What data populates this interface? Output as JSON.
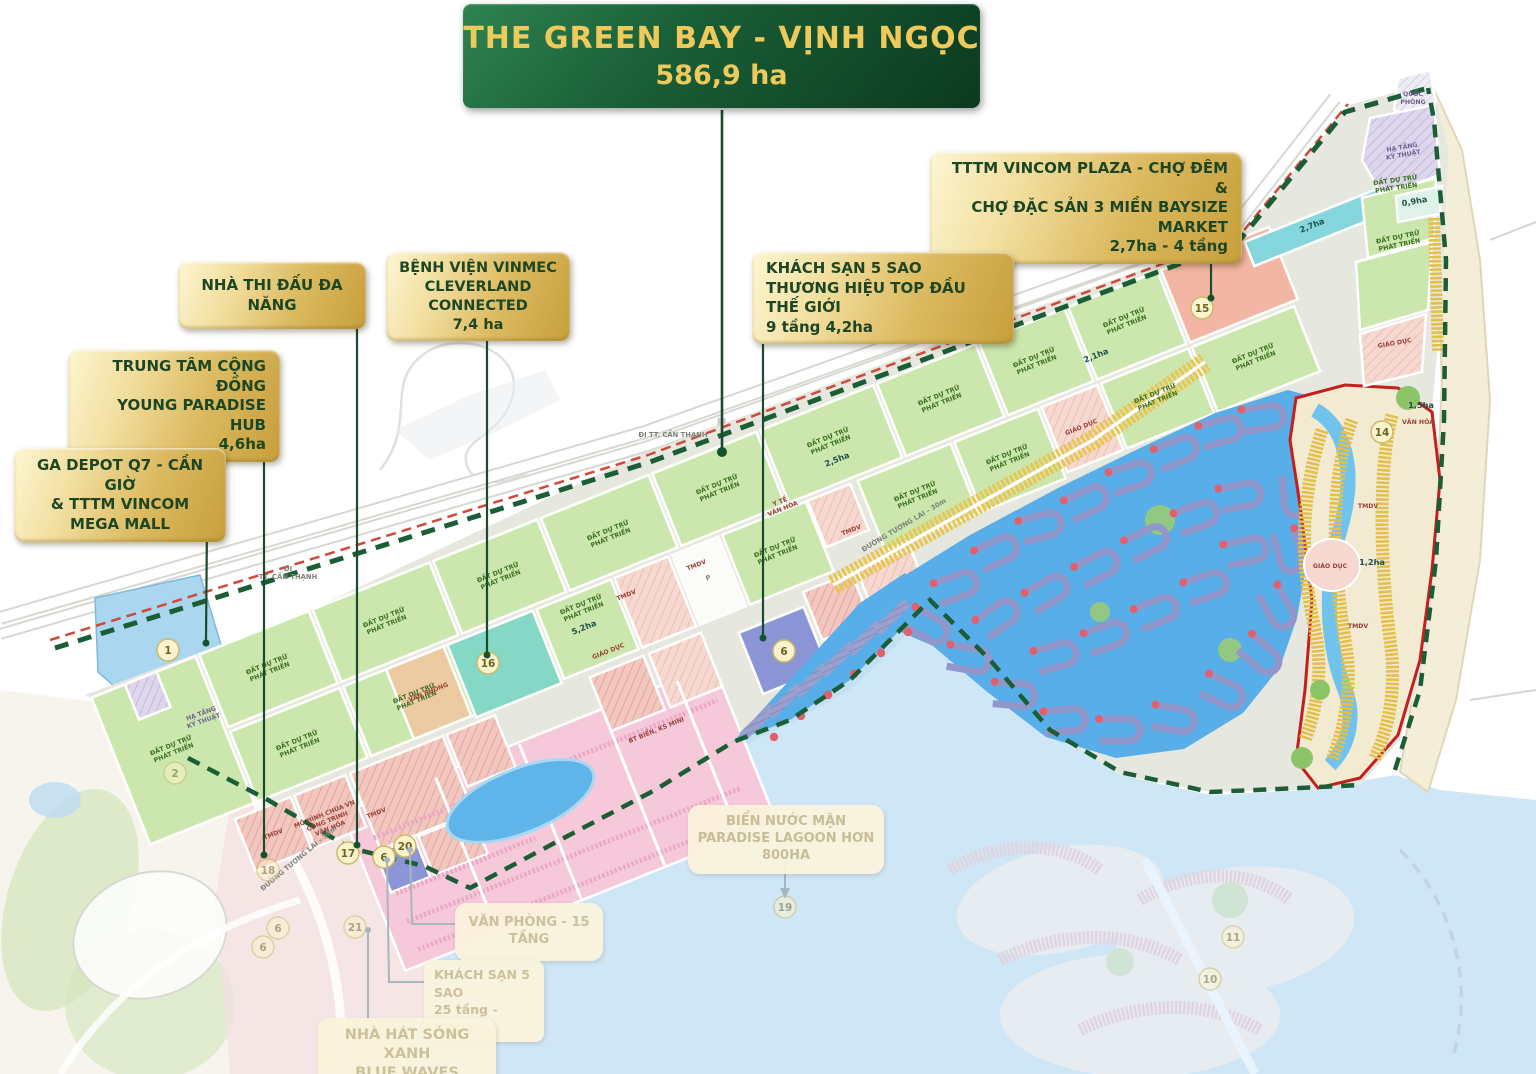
{
  "banner": {
    "title": "THE GREEN BAY - VỊNH NGỌC",
    "area": "586,9 ha"
  },
  "callouts": [
    {
      "id": "tttm",
      "style": "gold",
      "lines": [
        "TTTM VINCOM PLAZA - CHỢ ĐÊM &",
        "CHỢ ĐẶC SẢN 3 MIỀN BAYSIZE MARKET",
        "2,7ha - 4 tầng"
      ]
    },
    {
      "id": "nha-thi-dau",
      "style": "gold",
      "lines": [
        "NHÀ THI ĐẤU ĐA NĂNG"
      ]
    },
    {
      "id": "benh-vien",
      "style": "gold",
      "lines": [
        "BỆNH VIỆN VINMEC",
        "CLEVERLAND CONNECTED",
        "7,4 ha"
      ]
    },
    {
      "id": "khach-san-5-sao",
      "style": "gold",
      "lines": [
        "KHÁCH SẠN 5 SAO",
        "THƯƠNG HIỆU TOP ĐẦU THẾ GIỚI",
        "9 tầng 4,2ha"
      ]
    },
    {
      "id": "trung-tam",
      "style": "gold",
      "lines": [
        "TRUNG TÂM CỘNG ĐỒNG",
        "YOUNG PARADISE HUB",
        "4,6ha"
      ]
    },
    {
      "id": "ga-depot",
      "style": "gold",
      "lines": [
        "GA DEPOT Q7 - CẦN GIỜ",
        "& TTTM VINCOM",
        "MEGA MALL"
      ]
    },
    {
      "id": "van-phong",
      "style": "faded",
      "lines": [
        "VĂN PHÒNG - 15 TẦNG"
      ]
    },
    {
      "id": "khach-san-25",
      "style": "faded",
      "lines": [
        "KHÁCH SẠN 5 SAO",
        "25 tầng - 0,9ha"
      ]
    },
    {
      "id": "nha-hat",
      "style": "faded",
      "lines": [
        "NHÀ HÁT SÓNG XANH",
        "BLUE WAVES THEATRE"
      ]
    },
    {
      "id": "bien-nuoc-man",
      "style": "faded",
      "lines": [
        "BIỂN NƯỚC MẶN",
        "PARADISE LAGOON HƠN 800HA"
      ]
    }
  ],
  "map": {
    "markers": [
      {
        "n": "1",
        "x": 168,
        "y": 650
      },
      {
        "n": "15",
        "x": 1202,
        "y": 308
      },
      {
        "n": "16",
        "x": 488,
        "y": 663
      },
      {
        "n": "6",
        "x": 784,
        "y": 651
      },
      {
        "n": "17",
        "x": 348,
        "y": 853
      },
      {
        "n": "6",
        "x": 384,
        "y": 857
      },
      {
        "n": "20",
        "x": 405,
        "y": 846
      },
      {
        "n": "14",
        "x": 1382,
        "y": 432
      },
      {
        "n": "2",
        "x": 175,
        "y": 773,
        "faded": true
      },
      {
        "n": "18",
        "x": 268,
        "y": 870,
        "faded": true
      },
      {
        "n": "6",
        "x": 278,
        "y": 928,
        "faded": true
      },
      {
        "n": "6",
        "x": 263,
        "y": 947,
        "faded": true
      },
      {
        "n": "21",
        "x": 355,
        "y": 927,
        "faded": true
      },
      {
        "n": "19",
        "x": 785,
        "y": 907,
        "faded": true
      },
      {
        "n": "11",
        "x": 1233,
        "y": 937,
        "faded": true
      },
      {
        "n": "10",
        "x": 1210,
        "y": 979,
        "faded": true
      }
    ],
    "labels": [
      {
        "t": "ĐẤT DỰ TRỮ\nPHÁT TRIỂN",
        "x": 173,
        "y": 751,
        "r": -22,
        "c": "g"
      },
      {
        "t": "ĐẤT DỰ TRỮ\nPHÁT TRIỂN",
        "x": 269,
        "y": 670,
        "r": -22,
        "c": "g"
      },
      {
        "t": "ĐẤT DỰ TRỮ\nPHÁT TRIỂN",
        "x": 386,
        "y": 623,
        "r": -22,
        "c": "g"
      },
      {
        "t": "ĐẤT DỰ TRỮ\nPHÁT TRIỂN",
        "x": 500,
        "y": 578,
        "r": -22,
        "c": "g"
      },
      {
        "t": "ĐẤT DỰ TRỮ\nPHÁT TRIỂN",
        "x": 610,
        "y": 536,
        "r": -22,
        "c": "g"
      },
      {
        "t": "ĐẤT DỰ TRỮ\nPHÁT TRIỂN",
        "x": 719,
        "y": 490,
        "r": -22,
        "c": "g"
      },
      {
        "t": "ĐẤT DỰ TRỮ\nPHÁT TRIỂN",
        "x": 830,
        "y": 443,
        "r": -22,
        "c": "g"
      },
      {
        "t": "ĐẤT DỰ TRỮ\nPHÁT TRIỂN",
        "x": 941,
        "y": 401,
        "r": -22,
        "c": "g"
      },
      {
        "t": "ĐẤT DỰ TRỮ\nPHÁT TRIỂN",
        "x": 1036,
        "y": 363,
        "r": -22,
        "c": "g"
      },
      {
        "t": "ĐẤT DỰ TRỮ\nPHÁT TRIỂN",
        "x": 1126,
        "y": 323,
        "r": -22,
        "c": "g"
      },
      {
        "t": "ĐẤT DỰ TRỮ\nPHÁT TRIỂN",
        "x": 299,
        "y": 746,
        "r": -22,
        "c": "g"
      },
      {
        "t": "ĐẤT DỰ TRỮ\nPHÁT TRIỂN",
        "x": 416,
        "y": 699,
        "r": -22,
        "c": "g"
      },
      {
        "t": "ĐẤT DỰ TRỮ\nPHÁT TRIỂN",
        "x": 583,
        "y": 610,
        "r": -22,
        "c": "g"
      },
      {
        "t": "ĐẤT DỰ TRỮ\nPHÁT TRIỂN",
        "x": 777,
        "y": 553,
        "r": -22,
        "c": "g"
      },
      {
        "t": "ĐẤT DỰ TRỮ\nPHÁT TRIỂN",
        "x": 917,
        "y": 497,
        "r": -22,
        "c": "g"
      },
      {
        "t": "ĐẤT DỰ TRỮ\nPHÁT TRIỂN",
        "x": 1009,
        "y": 460,
        "r": -22,
        "c": "g"
      },
      {
        "t": "ĐẤT DỰ TRỮ\nPHÁT TRIỂN",
        "x": 1157,
        "y": 399,
        "r": -22,
        "c": "g"
      },
      {
        "t": "ĐẤT DỰ TRỮ\nPHÁT TRIỂN",
        "x": 1255,
        "y": 359,
        "r": -22,
        "c": "g"
      },
      {
        "t": "ĐẤT DỰ TRỮ\nPHÁT TRIỂN",
        "x": 1396,
        "y": 186,
        "r": -8,
        "c": "g"
      },
      {
        "t": "ĐẤT DỰ TRỮ\nPHÁT TRIỂN",
        "x": 1399,
        "y": 243,
        "r": -12,
        "c": "g"
      },
      {
        "t": "2,5ha",
        "x": 838,
        "y": 462,
        "r": -22,
        "c": "a"
      },
      {
        "t": "2,1ha",
        "x": 1097,
        "y": 358,
        "r": -22,
        "c": "a"
      },
      {
        "t": "5,2ha",
        "x": 585,
        "y": 630,
        "r": -22,
        "c": "a"
      },
      {
        "t": "2,7ha",
        "x": 1313,
        "y": 228,
        "r": -22,
        "c": "a"
      },
      {
        "t": "0,9ha",
        "x": 1415,
        "y": 204,
        "r": -10,
        "c": "a"
      },
      {
        "t": "1,5ha",
        "x": 1421,
        "y": 408,
        "r": 0,
        "c": "a"
      },
      {
        "t": "1,2ha",
        "x": 1372,
        "y": 565,
        "r": 0,
        "c": "a"
      },
      {
        "t": "VĂN PHÒNG",
        "x": 429,
        "y": 694,
        "r": -22,
        "c": "r"
      },
      {
        "t": "GIÁO DỤC",
        "x": 609,
        "y": 653,
        "r": -22,
        "c": "r"
      },
      {
        "t": "GIÁO DỤC",
        "x": 1082,
        "y": 429,
        "r": -22,
        "c": "r"
      },
      {
        "t": "GIÁO DỤC",
        "x": 1330,
        "y": 568,
        "r": 0,
        "c": "r"
      },
      {
        "t": "GIÁO DỤC",
        "x": 1395,
        "y": 345,
        "r": -10,
        "c": "r"
      },
      {
        "t": "TMDV",
        "x": 274,
        "y": 836,
        "r": -22,
        "c": "r"
      },
      {
        "t": "TMDV",
        "x": 377,
        "y": 815,
        "r": -22,
        "c": "r"
      },
      {
        "t": "TMDV",
        "x": 627,
        "y": 597,
        "r": -22,
        "c": "r"
      },
      {
        "t": "TMDV",
        "x": 697,
        "y": 567,
        "r": -22,
        "c": "r"
      },
      {
        "t": "TMDV",
        "x": 852,
        "y": 532,
        "r": -22,
        "c": "r"
      },
      {
        "t": "TMDV",
        "x": 1368,
        "y": 508,
        "r": 0,
        "c": "r"
      },
      {
        "t": "TMDV",
        "x": 1358,
        "y": 628,
        "r": 0,
        "c": "r"
      },
      {
        "t": "Y TẾ\nVĂN HÓA",
        "x": 782,
        "y": 507,
        "r": -22,
        "c": "r"
      },
      {
        "t": "BT BIỂN, KS MINI",
        "x": 657,
        "y": 732,
        "r": -22,
        "c": "r"
      },
      {
        "t": "MÔ HÌNH CHÙA VN\nCÔNG TRÌNH\nVĂN HÓA",
        "x": 328,
        "y": 823,
        "r": -22,
        "c": "r"
      },
      {
        "t": "VĂN HÓA",
        "x": 1418,
        "y": 424,
        "r": 0,
        "c": "r"
      },
      {
        "t": "QUỐC\nPHÒNG",
        "x": 1413,
        "y": 100,
        "r": 0,
        "c": "p"
      },
      {
        "t": "HẠ TẦNG\nKỸ THUẬT",
        "x": 1403,
        "y": 153,
        "r": -10,
        "c": "p"
      },
      {
        "t": "HẠ TẦNG\nKỸ THUẬT",
        "x": 203,
        "y": 719,
        "r": -20,
        "c": "p"
      },
      {
        "t": "ĐI\nTT. CẦN THẠNH",
        "x": 288,
        "y": 575,
        "r": 0,
        "c": "road"
      },
      {
        "t": "ĐI TT. CẦN THẠNH",
        "x": 673,
        "y": 437,
        "r": 0,
        "c": "road"
      },
      {
        "t": "ĐI TT. CẦN THẠNH",
        "x": 965,
        "y": 329,
        "r": 0,
        "c": "road"
      },
      {
        "t": "ĐI TT. CẦN THẠNH",
        "x": 1177,
        "y": 245,
        "r": 0,
        "c": "road"
      },
      {
        "t": "ĐƯỜNG TƯƠNG LAI - 30m",
        "x": 300,
        "y": 860,
        "r": -40,
        "c": "road"
      },
      {
        "t": "ĐƯỜNG TƯƠNG LAI - 30m",
        "x": 905,
        "y": 527,
        "r": -31,
        "c": "road"
      },
      {
        "t": "P",
        "x": 709,
        "y": 580,
        "r": -22,
        "c": "road"
      }
    ]
  },
  "colors": {
    "gold_label": "#d9b85e",
    "banner_green": "#14532d",
    "boundary_green": "#1b5e36",
    "boundary_red": "#c43a2e",
    "water": "#cfe6f7",
    "parcel_green": "#cbe7ae",
    "lagoon": "#58aee8",
    "zone14_outline": "#c41e1e"
  }
}
